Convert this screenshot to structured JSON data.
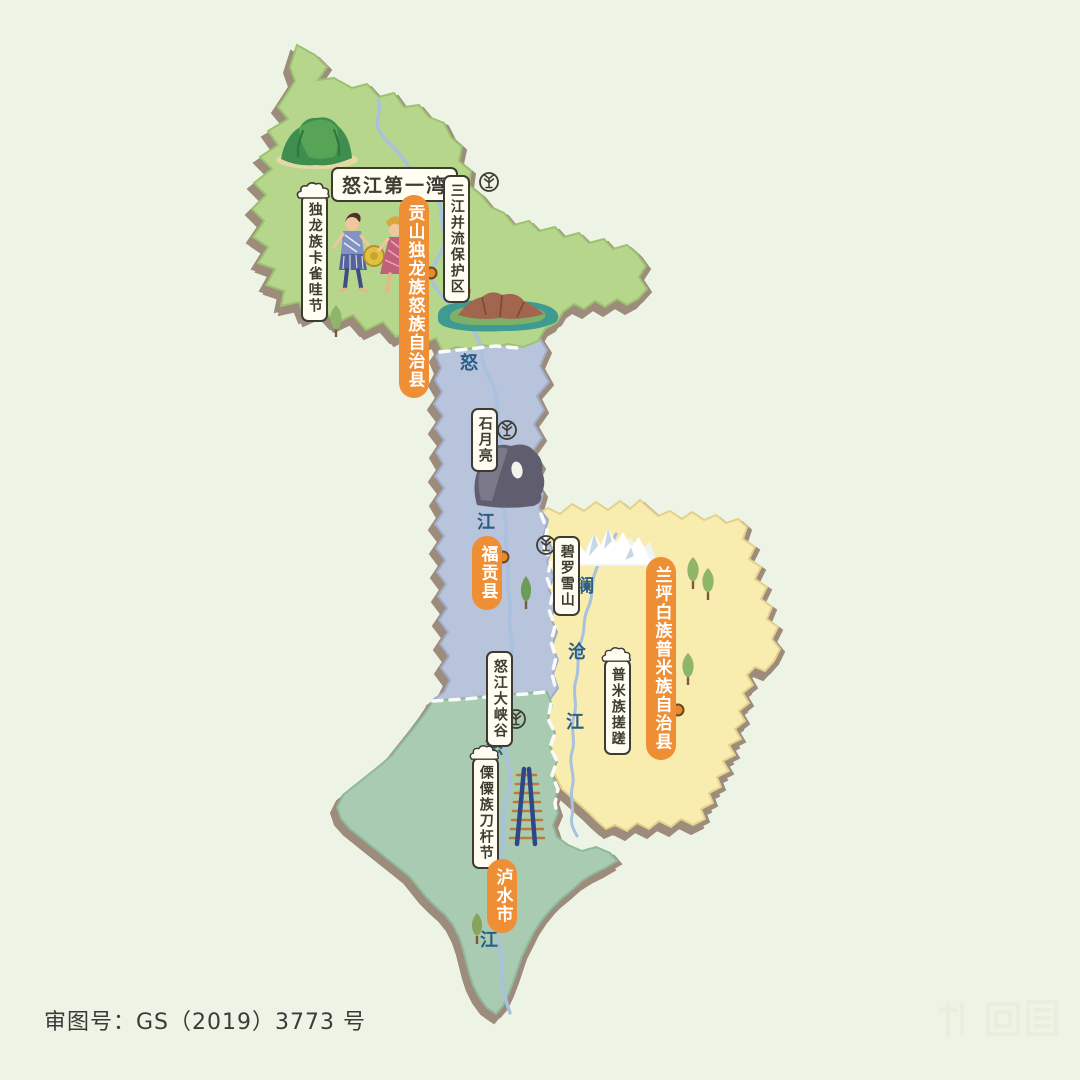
{
  "colors": {
    "background": "#eef4e5",
    "gongshan_fill": "#b6d78b",
    "fugong_fill": "#b8c3dc",
    "lanping_fill": "#f8ecae",
    "lushui_fill": "#a8cbb1",
    "shadow": "#9d8b7c",
    "river": "#a7c1de",
    "accent_orange": "#ee8f35",
    "label_ink": "#3c3c33",
    "river_text_blue": "#2a5e87"
  },
  "counties": {
    "gongshan": {
      "label": "贡山独龙族怒族自治县"
    },
    "fugong": {
      "label": "福贡县"
    },
    "lanping": {
      "label": "兰坪白族普米族自治县"
    },
    "lushui": {
      "label": "泸水市"
    }
  },
  "pois": {
    "nujiang_first_bend": "怒江第一湾",
    "three_parallel_rivers_reserve": "三江并流保护区",
    "dulong_kaquewa_festival": "独龙族卡雀哇节",
    "stone_moon": "石月亮",
    "biluo_snow_mountain": "碧罗雪山",
    "nujiang_grand_canyon": "怒江大峡谷",
    "pumi_cuocuo_dance": "普米族搓蹉",
    "lisu_daoganjie_festival": "傈僳族刀杆节"
  },
  "rivers": {
    "nu_upper": [
      "怒",
      "江"
    ],
    "nu_lower": [
      "怒",
      "江"
    ],
    "lancang": [
      "澜",
      "沧",
      "江"
    ]
  },
  "footer": {
    "map_approval_number": "审图号：GS（2019）3773 号"
  },
  "icons": {
    "scenic_spot": "scenic-spot-icon",
    "world_heritage": "world-heritage-icon",
    "county_seat": "county-seat-dot",
    "cloud": "cloud-icon"
  }
}
